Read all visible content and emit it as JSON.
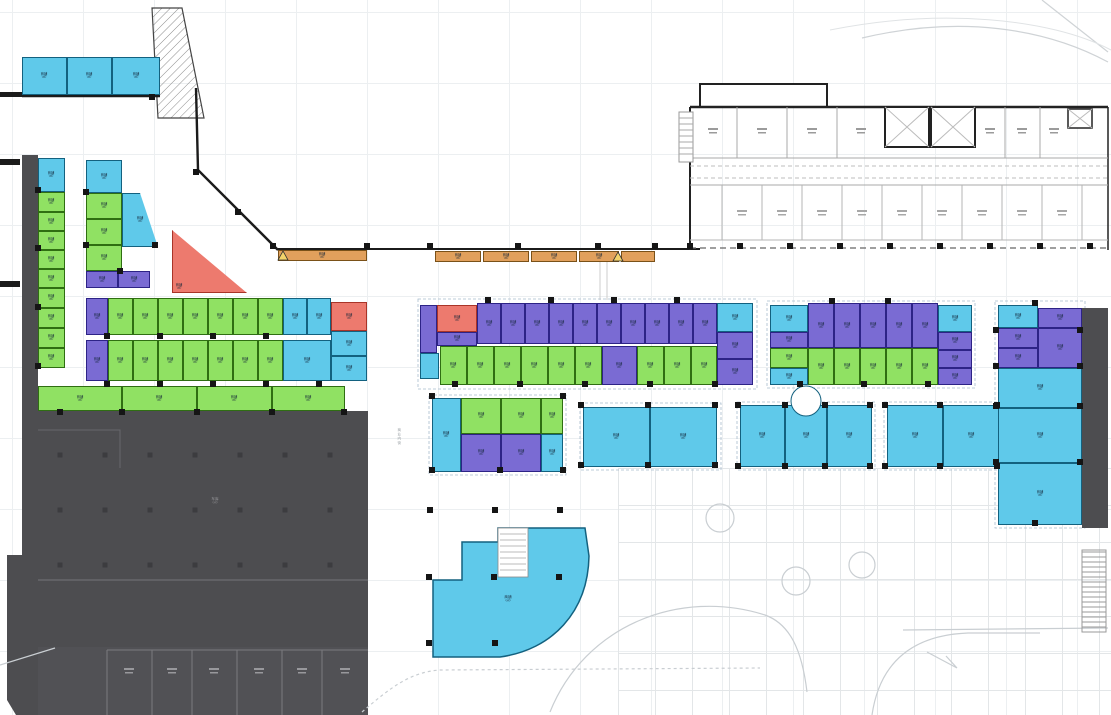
{
  "drawing": {
    "type": "commercial-retail-floor-plan",
    "palette": {
      "cyan_unit": "#5FC9EA",
      "green_unit": "#90E163",
      "purple_unit": "#7A6BD3",
      "red_unit": "#ED7A6E",
      "orange_canopy": "#E1A05C",
      "parking_dark": "#4D4D50",
      "wall": "#1B1B1B"
    }
  },
  "labels": {
    "unit_line1": "商铺",
    "unit_line2": "(㎡)",
    "parking_line1": "车库",
    "parking_line2": "(㎡)",
    "quarter_line1": "商铺",
    "quarter_line2": "(㎡)",
    "street": "商业内街"
  },
  "units": [
    [
      22,
      57,
      45,
      38,
      "cy"
    ],
    [
      67,
      57,
      45,
      38,
      "cy"
    ],
    [
      112,
      57,
      48,
      38,
      "cy"
    ],
    [
      38,
      158,
      27,
      34,
      "cy"
    ],
    [
      38,
      192,
      27,
      20,
      "gr"
    ],
    [
      38,
      212,
      27,
      19,
      "gr"
    ],
    [
      38,
      231,
      27,
      19,
      "gr"
    ],
    [
      38,
      250,
      27,
      19,
      "gr"
    ],
    [
      38,
      269,
      27,
      19,
      "gr"
    ],
    [
      38,
      288,
      27,
      20,
      "gr"
    ],
    [
      38,
      308,
      27,
      20,
      "gr"
    ],
    [
      38,
      328,
      27,
      20,
      "gr"
    ],
    [
      38,
      348,
      27,
      20,
      "gr"
    ],
    [
      86,
      160,
      36,
      33,
      "cy"
    ],
    [
      86,
      193,
      36,
      26,
      "gr"
    ],
    [
      86,
      219,
      36,
      26,
      "gr"
    ],
    [
      86,
      245,
      36,
      26,
      "gr"
    ],
    [
      86,
      271,
      32,
      17,
      "pu"
    ],
    [
      118,
      271,
      32,
      17,
      "pu"
    ],
    [
      122,
      193,
      36,
      54,
      "cy",
      "diag"
    ],
    [
      172,
      230,
      75,
      63,
      "rd",
      "tri"
    ],
    [
      86,
      298,
      22,
      37,
      "pu"
    ],
    [
      108,
      298,
      25,
      37,
      "gr"
    ],
    [
      133,
      298,
      25,
      37,
      "gr"
    ],
    [
      158,
      298,
      25,
      37,
      "gr"
    ],
    [
      183,
      298,
      25,
      37,
      "gr"
    ],
    [
      208,
      298,
      25,
      37,
      "gr"
    ],
    [
      233,
      298,
      25,
      37,
      "gr"
    ],
    [
      258,
      298,
      25,
      37,
      "gr"
    ],
    [
      283,
      298,
      24,
      37,
      "cy"
    ],
    [
      307,
      298,
      24,
      37,
      "cy"
    ],
    [
      331,
      302,
      36,
      29,
      "rd"
    ],
    [
      331,
      331,
      36,
      25,
      "cy"
    ],
    [
      331,
      356,
      36,
      25,
      "cy"
    ],
    [
      86,
      340,
      22,
      41,
      "pu"
    ],
    [
      108,
      340,
      25,
      41,
      "gr"
    ],
    [
      133,
      340,
      25,
      41,
      "gr"
    ],
    [
      158,
      340,
      25,
      41,
      "gr"
    ],
    [
      183,
      340,
      25,
      41,
      "gr"
    ],
    [
      208,
      340,
      25,
      41,
      "gr"
    ],
    [
      233,
      340,
      25,
      41,
      "gr"
    ],
    [
      258,
      340,
      25,
      41,
      "gr"
    ],
    [
      283,
      340,
      48,
      41,
      "cy"
    ],
    [
      38,
      386,
      84,
      25,
      "gr"
    ],
    [
      122,
      386,
      75,
      25,
      "gr"
    ],
    [
      197,
      386,
      75,
      25,
      "gr"
    ],
    [
      272,
      386,
      73,
      25,
      "gr"
    ],
    [
      437,
      305,
      40,
      27,
      "rd"
    ],
    [
      477,
      303,
      24,
      41,
      "pu"
    ],
    [
      501,
      303,
      24,
      41,
      "pu"
    ],
    [
      525,
      303,
      24,
      41,
      "pu"
    ],
    [
      549,
      303,
      24,
      41,
      "pu"
    ],
    [
      573,
      303,
      24,
      41,
      "pu"
    ],
    [
      597,
      303,
      24,
      41,
      "pu"
    ],
    [
      621,
      303,
      24,
      41,
      "pu"
    ],
    [
      645,
      303,
      24,
      41,
      "pu"
    ],
    [
      669,
      303,
      24,
      41,
      "pu"
    ],
    [
      693,
      303,
      24,
      41,
      "pu"
    ],
    [
      717,
      303,
      36,
      29,
      "cy"
    ],
    [
      717,
      332,
      36,
      27,
      "pu"
    ],
    [
      717,
      359,
      36,
      26,
      "pu"
    ],
    [
      420,
      305,
      17,
      48,
      "pu"
    ],
    [
      420,
      353,
      19,
      26,
      "cy"
    ],
    [
      437,
      332,
      40,
      14,
      "pu"
    ],
    [
      440,
      346,
      27,
      39,
      "gr"
    ],
    [
      467,
      346,
      27,
      39,
      "gr"
    ],
    [
      494,
      346,
      27,
      39,
      "gr"
    ],
    [
      521,
      346,
      27,
      39,
      "gr"
    ],
    [
      548,
      346,
      27,
      39,
      "gr"
    ],
    [
      575,
      346,
      27,
      39,
      "gr"
    ],
    [
      602,
      346,
      35,
      39,
      "pu"
    ],
    [
      637,
      346,
      27,
      39,
      "gr"
    ],
    [
      664,
      346,
      27,
      39,
      "gr"
    ],
    [
      691,
      346,
      26,
      39,
      "gr"
    ],
    [
      432,
      398,
      29,
      74,
      "cy"
    ],
    [
      461,
      398,
      40,
      36,
      "gr"
    ],
    [
      501,
      398,
      40,
      36,
      "gr"
    ],
    [
      541,
      398,
      22,
      36,
      "gr"
    ],
    [
      461,
      434,
      40,
      38,
      "pu"
    ],
    [
      501,
      434,
      40,
      38,
      "pu"
    ],
    [
      541,
      434,
      22,
      38,
      "cy"
    ],
    [
      583,
      407,
      67,
      60,
      "cy"
    ],
    [
      650,
      407,
      67,
      60,
      "cy"
    ],
    [
      740,
      405,
      45,
      62,
      "cy"
    ],
    [
      785,
      405,
      42,
      62,
      "cy"
    ],
    [
      827,
      405,
      45,
      62,
      "cy"
    ],
    [
      887,
      405,
      56,
      62,
      "cy"
    ],
    [
      943,
      405,
      57,
      62,
      "cy"
    ],
    [
      770,
      305,
      38,
      27,
      "cy"
    ],
    [
      808,
      303,
      26,
      45,
      "pu"
    ],
    [
      834,
      303,
      26,
      45,
      "pu"
    ],
    [
      860,
      303,
      26,
      45,
      "pu"
    ],
    [
      886,
      303,
      26,
      45,
      "pu"
    ],
    [
      912,
      303,
      26,
      45,
      "pu"
    ],
    [
      938,
      305,
      34,
      27,
      "cy"
    ],
    [
      770,
      332,
      38,
      16,
      "pu"
    ],
    [
      770,
      348,
      38,
      20,
      "gr"
    ],
    [
      770,
      368,
      38,
      17,
      "cy"
    ],
    [
      808,
      348,
      26,
      37,
      "gr"
    ],
    [
      834,
      348,
      26,
      37,
      "gr"
    ],
    [
      860,
      348,
      26,
      37,
      "gr"
    ],
    [
      886,
      348,
      26,
      37,
      "gr"
    ],
    [
      912,
      348,
      26,
      37,
      "gr"
    ],
    [
      938,
      332,
      34,
      18,
      "pu"
    ],
    [
      938,
      350,
      34,
      18,
      "pu"
    ],
    [
      938,
      368,
      34,
      17,
      "pu"
    ],
    [
      998,
      305,
      40,
      23,
      "cy"
    ],
    [
      1038,
      308,
      44,
      20,
      "pu"
    ],
    [
      998,
      328,
      40,
      20,
      "pu"
    ],
    [
      998,
      348,
      40,
      20,
      "pu"
    ],
    [
      1038,
      328,
      44,
      40,
      "pu"
    ],
    [
      998,
      368,
      84,
      40,
      "cy"
    ],
    [
      998,
      408,
      84,
      55,
      "cy"
    ],
    [
      998,
      463,
      84,
      62,
      "cy"
    ],
    [
      278,
      250,
      89,
      11,
      "or"
    ],
    [
      435,
      251,
      46,
      11,
      "or"
    ],
    [
      483,
      251,
      46,
      11,
      "or"
    ],
    [
      531,
      251,
      46,
      11,
      "or"
    ],
    [
      579,
      251,
      40,
      11,
      "or"
    ],
    [
      621,
      251,
      34,
      11,
      "or"
    ]
  ]
}
